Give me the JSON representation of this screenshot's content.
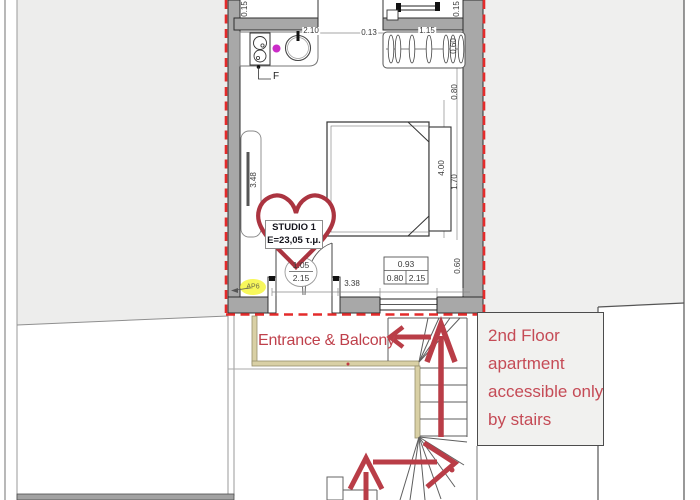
{
  "palette": {
    "wall_gray": "#a8a8a8",
    "site_gray": "#ededec",
    "boundary_red_dashed": "#e42b2b",
    "annotation_red": "#bf404b",
    "heart_red": "#ab3440",
    "railing_tan": "#d9d0a5",
    "magenta_dot": "#cb2cc8",
    "highlight_yellow": "#f6f63e"
  },
  "plan": {
    "studio_label": {
      "name": "STUDIO 1",
      "area": "E=23,05 τ.μ."
    },
    "f_label": "F",
    "window_tag": "ΑΡ6",
    "dimensions": {
      "top_left_wall": "0.15",
      "kitchen_width": "2.10",
      "gap": "0.13",
      "wardrobe_width": "1.15",
      "top_right_wall": "0.15",
      "wardrobe_depth": "0.60",
      "right_upper": "0.80",
      "room_length": "4.00",
      "bed_width": "1.70",
      "left_height": "3.48",
      "window_offset": "0.60",
      "bottom_span": "3.38",
      "door_size": {
        "width": "1.05",
        "height": "2.15"
      },
      "window_size": {
        "total": "0.93",
        "width": "0.80",
        "height": "2.15"
      }
    }
  },
  "annotations": {
    "entrance": "Entrance & Balcony",
    "stairs_note": [
      "2nd Floor",
      "apartment",
      "accessible only",
      "by stairs"
    ]
  }
}
